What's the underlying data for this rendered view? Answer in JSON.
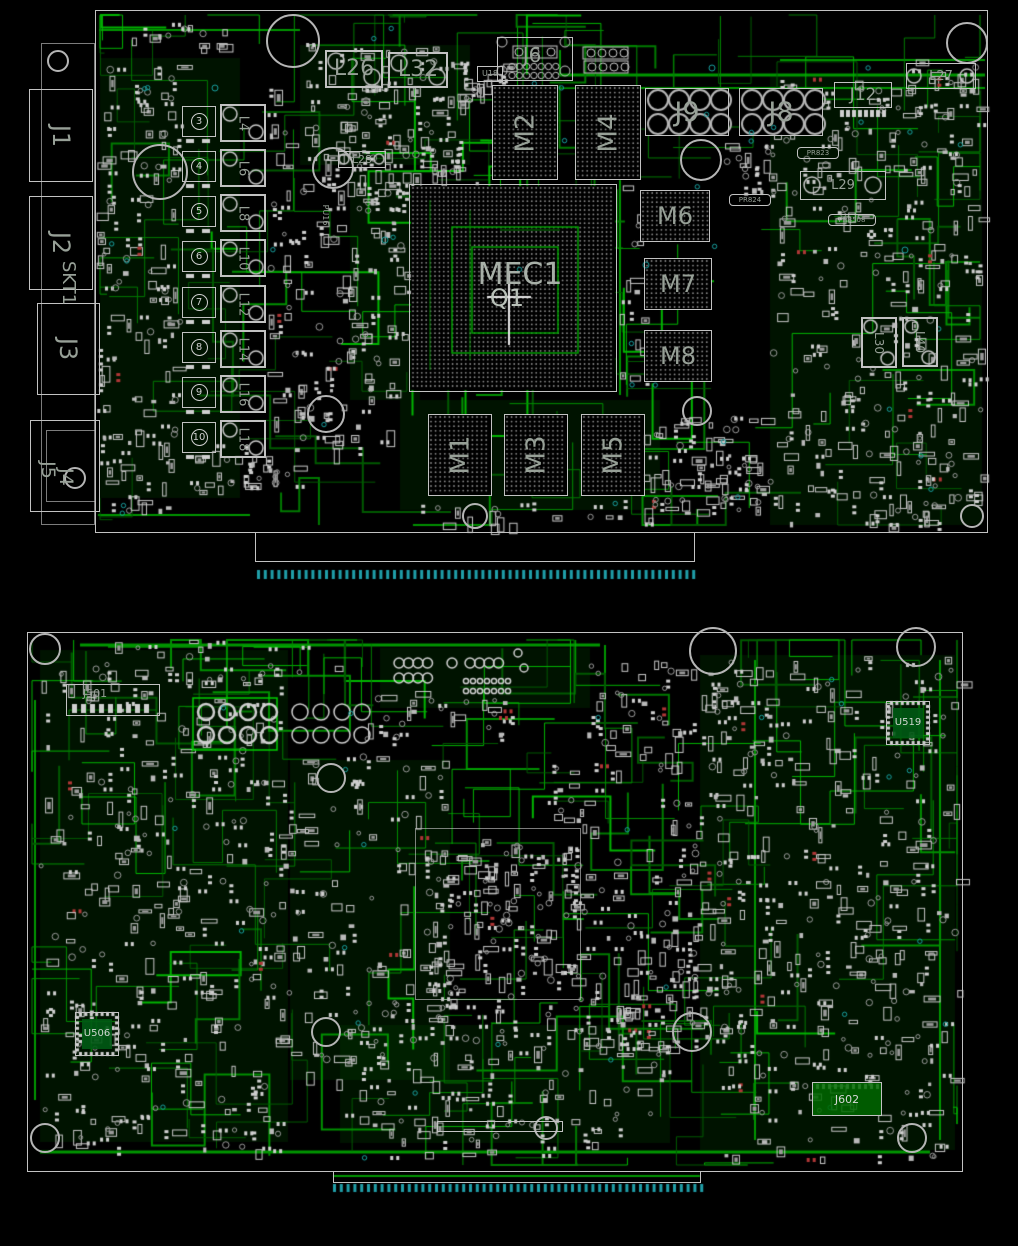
{
  "diagram": {
    "kind": "pcb-assembly-drawing-top-and-bottom",
    "colors": {
      "background": "#000000",
      "trace_green": "#008a00",
      "bright_green": "#00b400",
      "silkscreen": "#c8c8c8",
      "refdes_text": "#97a097",
      "edge_fingers": "#1f9ea8"
    },
    "top": {
      "connectors": {
        "j1": "J1",
        "j2": "J2",
        "skt1": "SKT1",
        "j3": "J3",
        "j4": "J4",
        "j5": "J5",
        "j6": "J6",
        "j8": "J8",
        "j9": "J9",
        "j12": "J12"
      },
      "gpu": {
        "ref": "MEC1",
        "marker": "Q1"
      },
      "memory": [
        "M1",
        "M2",
        "M3",
        "M4",
        "M5",
        "M6",
        "M7",
        "M8"
      ],
      "vrm": {
        "phases": [
          "3",
          "4",
          "5",
          "6",
          "7",
          "8",
          "9",
          "10"
        ],
        "inductors": [
          "L4",
          "L6",
          "L8",
          "L10",
          "L12",
          "L14",
          "L16",
          "L18"
        ]
      },
      "inductors": {
        "l26": "L26",
        "l27": "L27",
        "l28": "L28",
        "l29": "L29",
        "l30": "L30",
        "l32": "L32",
        "l40": "L40"
      },
      "small": {
        "u18": "U18",
        "pu16": "PU16",
        "pr823": "PR823",
        "pr824": "PR824",
        "pr8508": "PR8508"
      }
    },
    "bottom": {
      "refs": {
        "j501": "J501",
        "u519": "U519",
        "u506": "U506",
        "j602": "J602"
      }
    }
  }
}
